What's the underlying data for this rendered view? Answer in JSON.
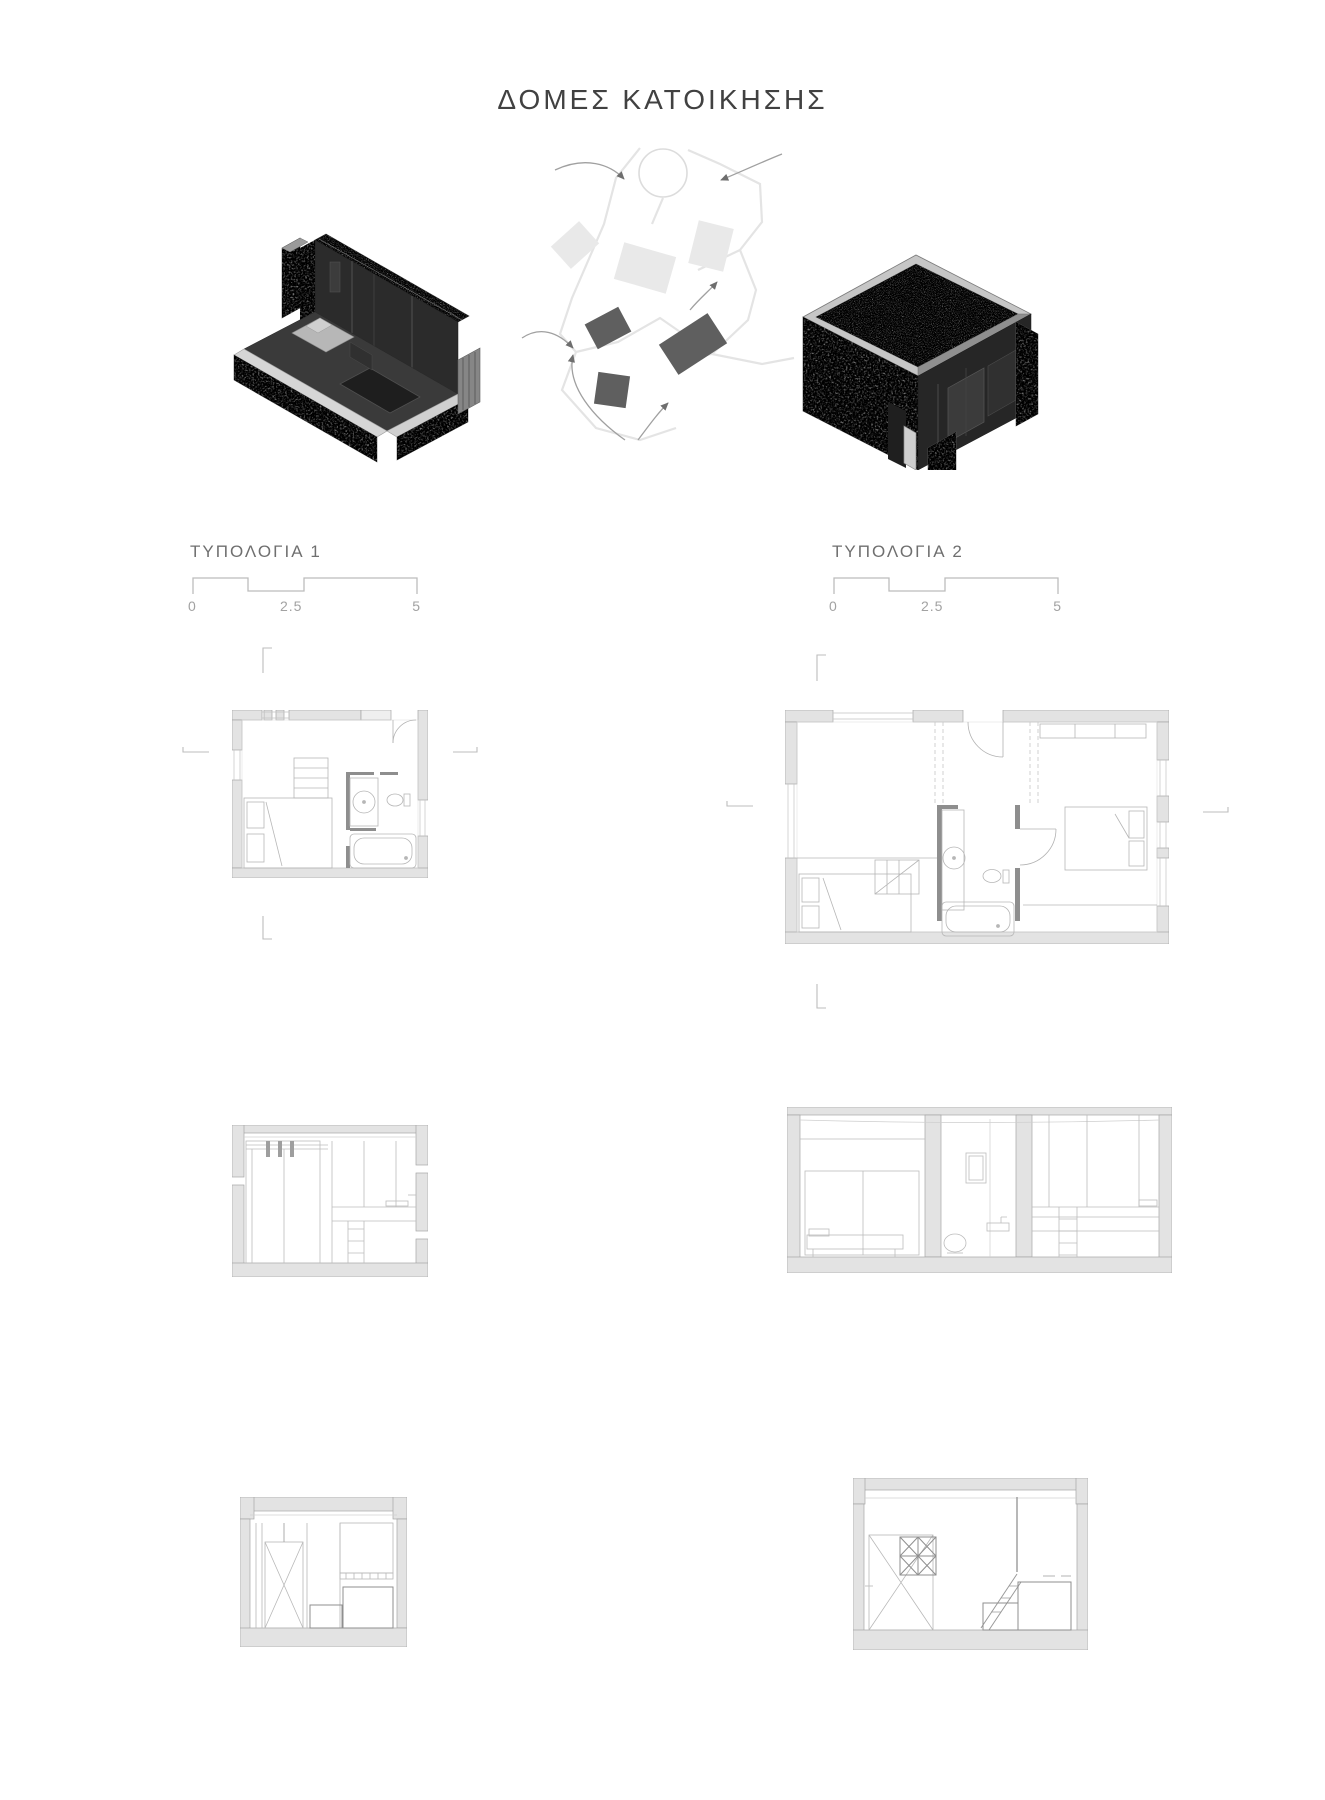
{
  "title": "ΔΟΜΕΣ ΚΑΤΟΙΚΗΣΗΣ",
  "typologies": [
    {
      "label": "ΤΥΠΟΛΟΓΙΑ 1",
      "scale_labels": [
        "0",
        "2.5",
        "5"
      ]
    },
    {
      "label": "ΤΥΠΟΛΟΓΙΑ 2",
      "scale_labels": [
        "0",
        "2.5",
        "5"
      ]
    }
  ],
  "colors": {
    "background": "#ffffff",
    "wall_poche": "#e3e3e3",
    "wall_outline": "#a5a5a5",
    "furniture_line": "#b4b4b4",
    "dark_partition": "#8e8e8e",
    "interior_dark": "#2c2c2c",
    "stone_gray": "#828282",
    "gravel_gray": "#b0b0b0",
    "site_block_light": "#e9e9e9",
    "site_block_dark": "#5f5f5f",
    "text_dark": "#414141",
    "text_gray": "#a2a2a2"
  }
}
